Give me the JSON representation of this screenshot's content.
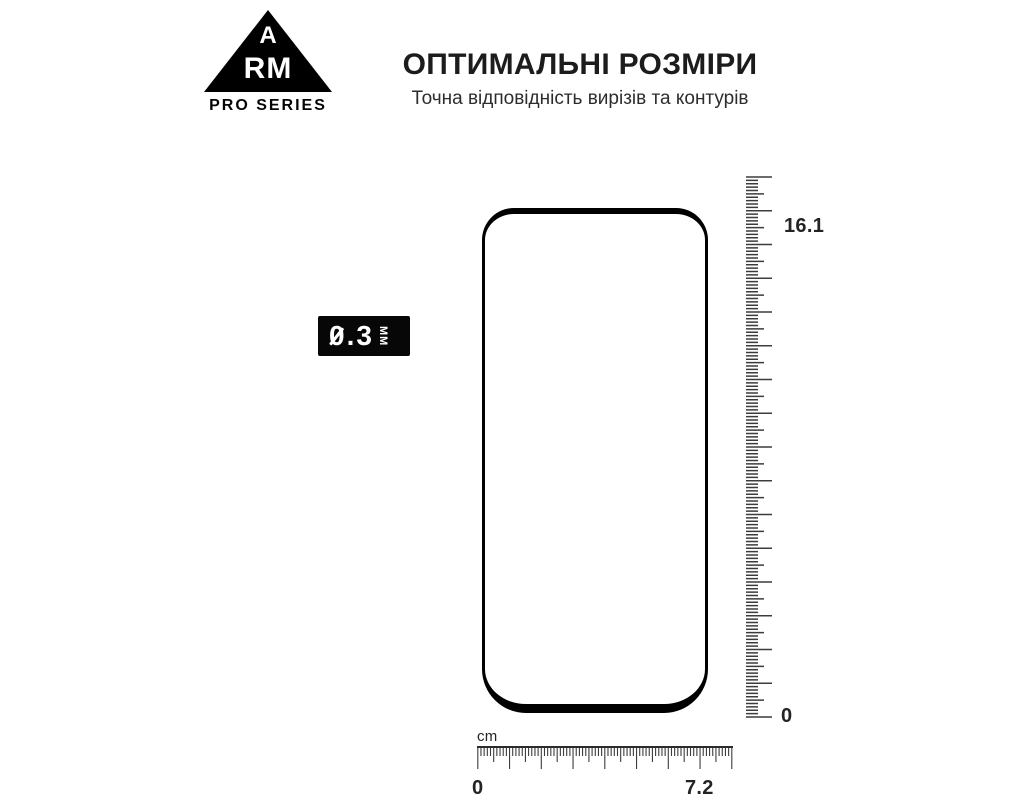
{
  "brand": {
    "letter_a": "A",
    "letters_rm": "RM",
    "tagline": "PRO SERIES"
  },
  "header": {
    "title": "ОПТИМАЛЬНІ РОЗМІРИ",
    "subtitle": "Точна відповідність вирізів та контурів"
  },
  "thickness_badge": {
    "value": "0.3",
    "unit": "ММ"
  },
  "rulers": {
    "vertical": {
      "max_label": "16.1",
      "min_label": "0",
      "length_mm": 160
    },
    "horizontal": {
      "unit_label": "cm",
      "start_label": "0",
      "end_label": "7.2",
      "length_mm": 80
    }
  },
  "dimensions": {
    "height_cm": 16.1,
    "width_cm": 7.2,
    "thickness_mm": 0.3
  },
  "colors": {
    "ink": "#1c1c1c",
    "tick": "#3c3c3c",
    "badge_bg": "#070707"
  }
}
